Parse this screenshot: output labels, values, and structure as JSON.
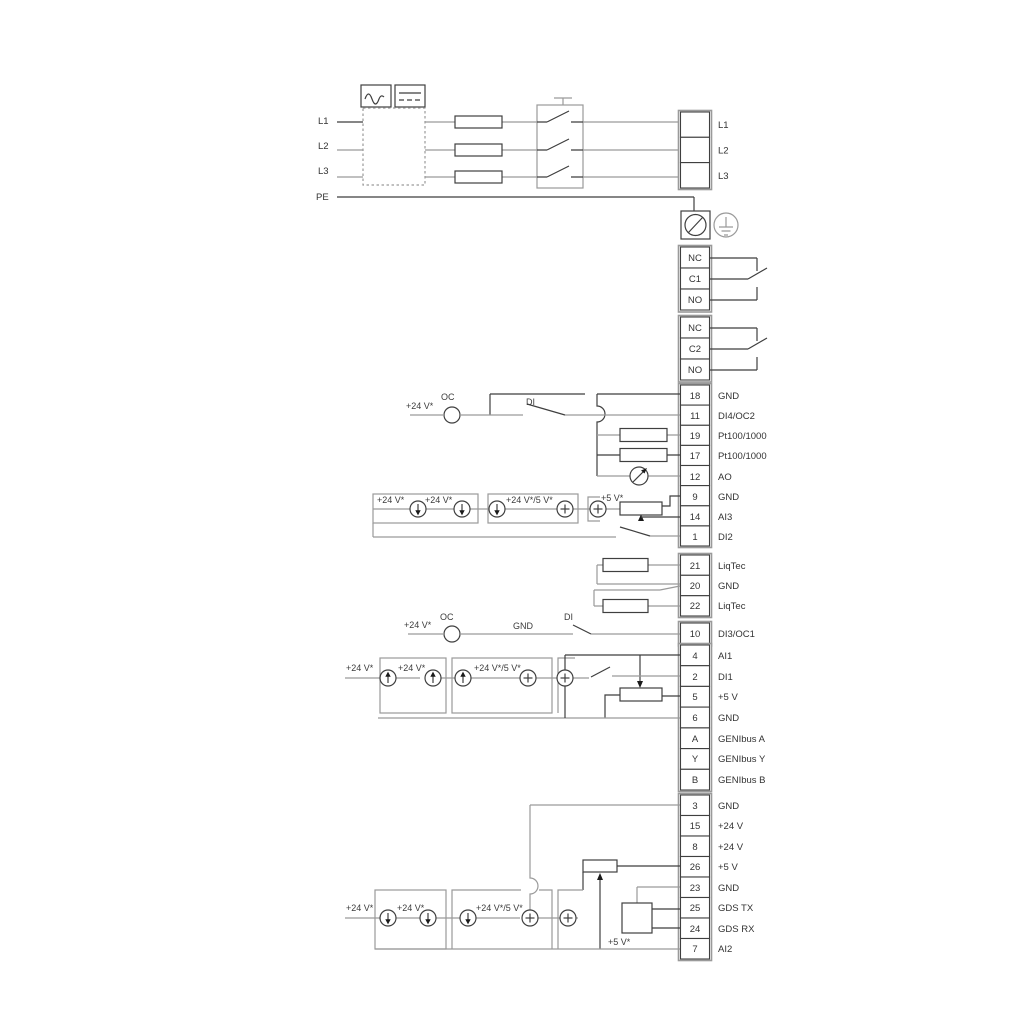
{
  "colors": {
    "wire_gray": "#9a9a9a",
    "wire_dark": "#3f3f3f",
    "text": "#333333"
  },
  "mains": {
    "l1": "L1",
    "l2": "L2",
    "l3": "L3",
    "pe": "PE"
  },
  "top_block": {
    "rows": [
      {
        "label": "L1"
      },
      {
        "label": "L2"
      },
      {
        "label": "L3"
      }
    ]
  },
  "relay1": {
    "rows": [
      "NC",
      "C1",
      "NO"
    ]
  },
  "relay2": {
    "rows": [
      "NC",
      "C2",
      "NO"
    ]
  },
  "block1": {
    "rows": [
      {
        "num": "18",
        "label": "GND"
      },
      {
        "num": "11",
        "label": "DI4/OC2"
      },
      {
        "num": "19",
        "label": "Pt100/1000"
      },
      {
        "num": "17",
        "label": "Pt100/1000"
      },
      {
        "num": "12",
        "label": "AO"
      },
      {
        "num": "9",
        "label": "GND"
      },
      {
        "num": "14",
        "label": "AI3"
      },
      {
        "num": "1",
        "label": "DI2"
      }
    ]
  },
  "liqtec_block": {
    "rows": [
      {
        "num": "21",
        "label": "LiqTec"
      },
      {
        "num": "20",
        "label": "GND"
      },
      {
        "num": "22",
        "label": "LiqTec"
      }
    ]
  },
  "di3_block": {
    "num": "10",
    "label": "DI3/OC1"
  },
  "block2": {
    "rows": [
      {
        "num": "4",
        "label": "AI1"
      },
      {
        "num": "2",
        "label": "DI1"
      },
      {
        "num": "5",
        "label": "+5 V"
      },
      {
        "num": "6",
        "label": "GND"
      },
      {
        "num": "A",
        "label": "GENIbus A"
      },
      {
        "num": "Y",
        "label": "GENIbus Y"
      },
      {
        "num": "B",
        "label": "GENIbus B"
      }
    ]
  },
  "block3": {
    "rows": [
      {
        "num": "3",
        "label": "GND"
      },
      {
        "num": "15",
        "label": "+24 V"
      },
      {
        "num": "8",
        "label": "+24 V"
      },
      {
        "num": "26",
        "label": "+5 V"
      },
      {
        "num": "23",
        "label": "GND"
      },
      {
        "num": "25",
        "label": "GDS TX"
      },
      {
        "num": "24",
        "label": "GDS RX"
      },
      {
        "num": "7",
        "label": "AI2"
      }
    ]
  },
  "wire_labels": {
    "di4_v24": "+24 V*",
    "di4_oc": "OC",
    "di4_di": "DI",
    "ai3_v24_a": "+24 V*",
    "ai3_v24_b": "+24 V*",
    "ai3_v24_5v": "+24 V*/5 V*",
    "ai3_5v": "+5 V*",
    "di3_v24": "+24 V*",
    "di3_oc": "OC",
    "di3_gnd": "GND",
    "di3_di": "DI",
    "ai1_v24_a": "+24 V*",
    "ai1_v24_b": "+24 V*",
    "ai1_v24_5v": "+24 V*/5 V*",
    "ai2_v24_a": "+24 V*",
    "ai2_v24_b": "+24 V*",
    "ai2_v24_5v": "+24 V*/5 V*",
    "ai2_5v": "+5 V*"
  }
}
